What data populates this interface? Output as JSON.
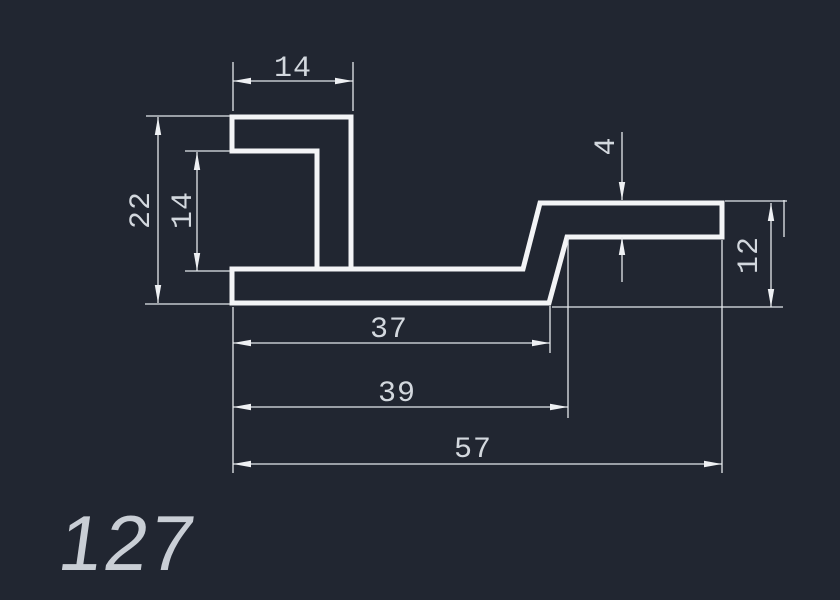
{
  "drawing": {
    "part_number": "127",
    "dimensions": {
      "top_flange_width": "14",
      "overall_height": "22",
      "opening_height": "14",
      "flange_thickness": "4",
      "right_end_height": "12",
      "bottom_length": "37",
      "mid_length": "39",
      "overall_length": "57"
    },
    "colors": {
      "background": "#212631",
      "profile_line": "#f3f4f6",
      "dimension_line": "#e4e8ec",
      "dim_text": "#d3d8de",
      "part_text": "#c9ced5"
    }
  }
}
